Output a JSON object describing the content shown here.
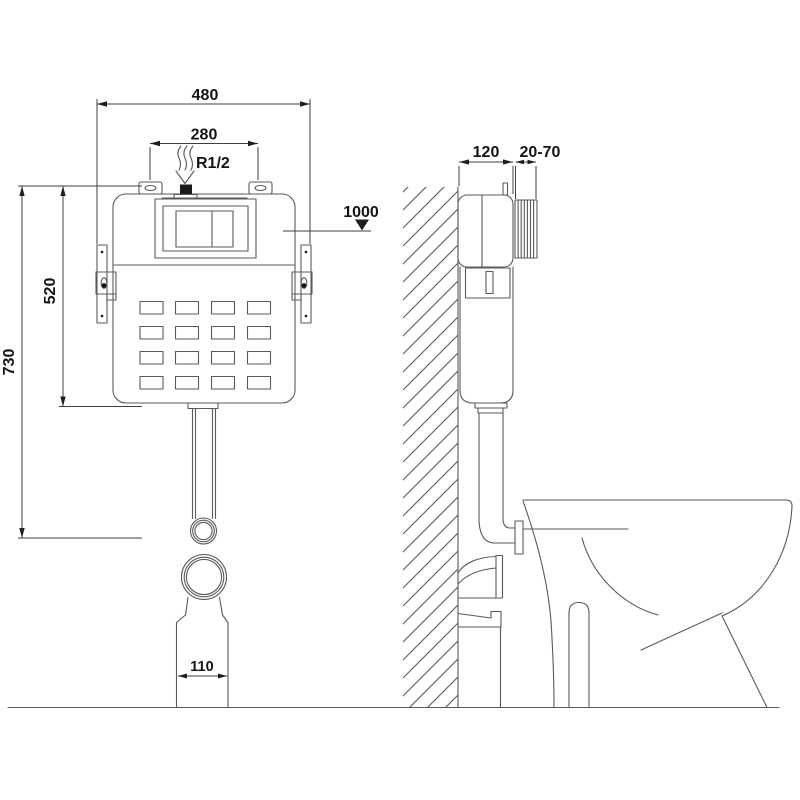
{
  "colors": {
    "background": "#ffffff",
    "object_line": "#5a5a5a",
    "dimension_line": "#3f3f3f",
    "text": "#141414",
    "solid_fill": "#1a1a1a"
  },
  "front_view": {
    "labels": {
      "overall_width": "480",
      "inlet_spacing": "280",
      "water_inlet_thread": "R1/2",
      "level_mark": "1000",
      "cistern_height": "520",
      "overall_height": "730",
      "outlet_width": "110"
    }
  },
  "side_view": {
    "labels": {
      "frame_depth": "120",
      "plate_adjustment_range": "20-70"
    }
  }
}
